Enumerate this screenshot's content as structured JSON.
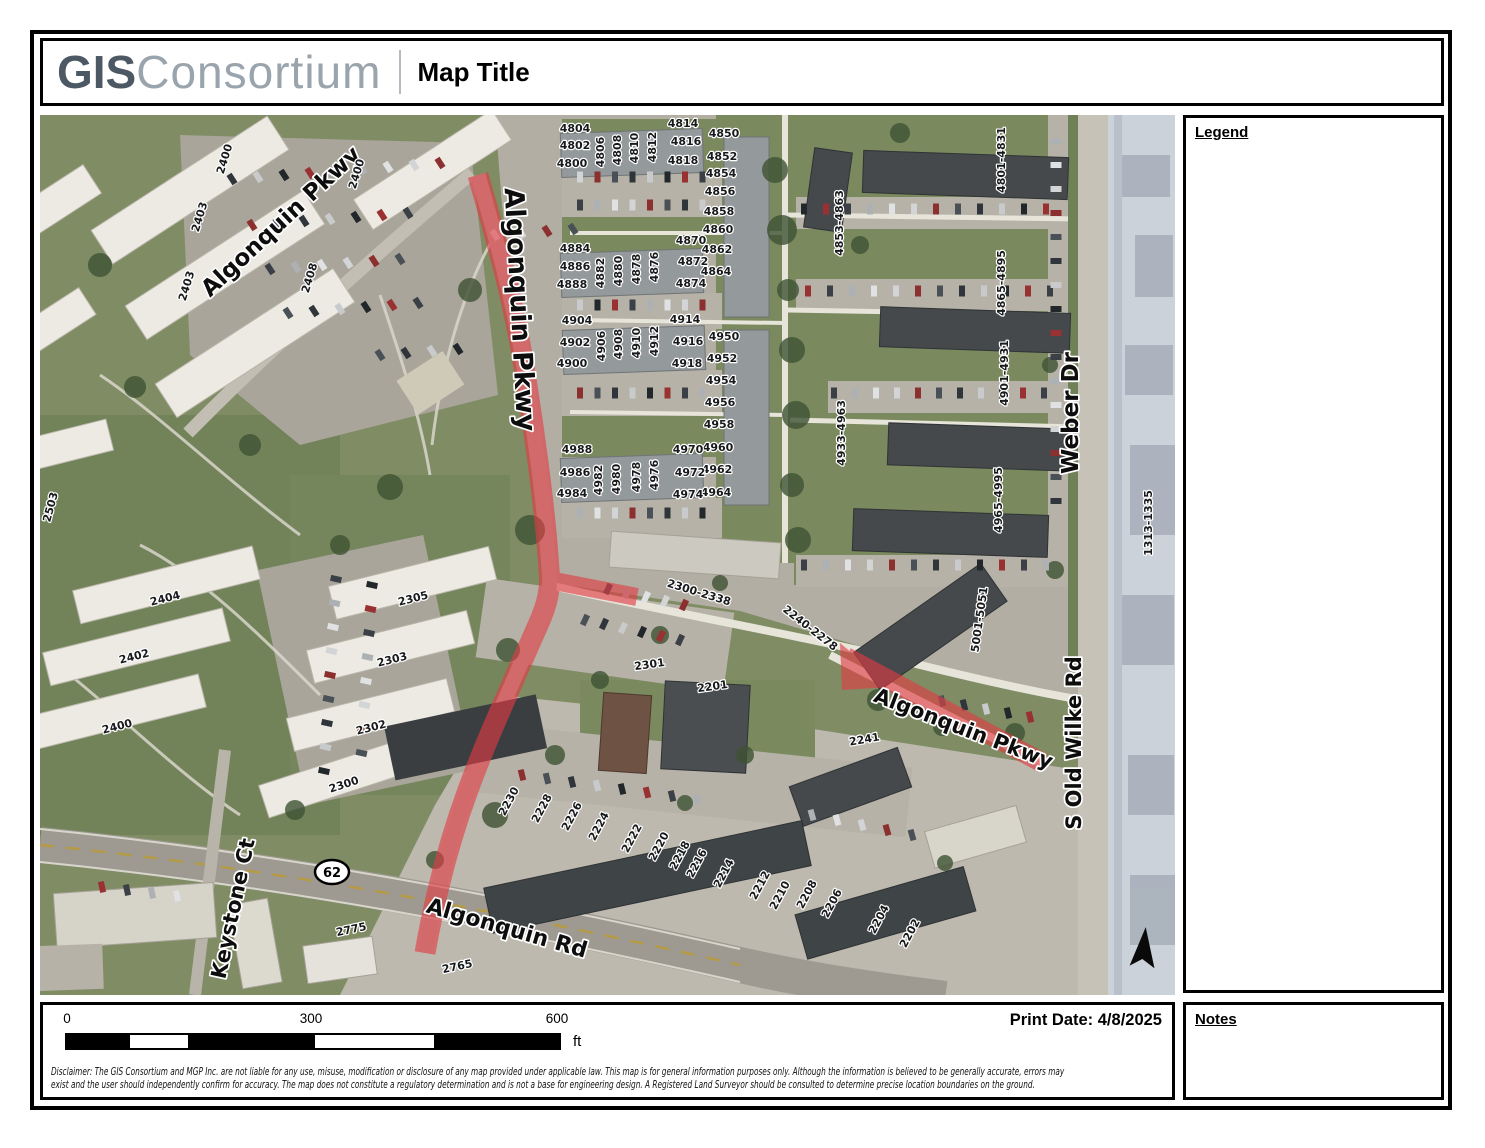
{
  "header": {
    "brand_bold": "GIS",
    "brand_light": "Consortium",
    "title": "Map Title"
  },
  "panels": {
    "legend_title": "Legend",
    "notes_title": "Notes"
  },
  "footer": {
    "print_date": "Print Date: 4/8/2025",
    "disclaimer_line1": "Disclaimer: The GIS Consortium and MGP Inc. are not liable for any use, misuse, modification or disclosure of any map provided under applicable law.  This map is for general information purposes only. Although the information is believed to be generally accurate, errors may",
    "disclaimer_line2": "exist and the user should independently confirm for accuracy. The map does not constitute a regulatory determination and is not a base for engineering design. A Registered Land Surveyor should be consulted to determine precise location boundaries on the ground."
  },
  "scalebar": {
    "start": "0",
    "middle": "300",
    "end": "600",
    "unit": "ft"
  },
  "map": {
    "highlight_color": "#e23c44",
    "route_shield": "62",
    "street_labels": [
      {
        "t": "Algonquin Pkwy",
        "x": 246,
        "y": 112,
        "r": -43,
        "s": 23
      },
      {
        "t": "Algonquin Pkwy",
        "x": 471,
        "y": 195,
        "r": 87,
        "s": 27
      },
      {
        "t": "Weber Dr",
        "x": 1038,
        "y": 298,
        "r": -90,
        "s": 23
      },
      {
        "t": "S Old Wilke Rd",
        "x": 1041,
        "y": 628,
        "r": -90,
        "s": 21
      },
      {
        "t": "Algonquin Pkwy",
        "x": 921,
        "y": 620,
        "r": 21,
        "s": 21
      },
      {
        "t": "Algonquin Rd",
        "x": 465,
        "y": 820,
        "r": 16,
        "s": 22
      },
      {
        "t": "Keystone Ct",
        "x": 200,
        "y": 795,
        "r": -78,
        "s": 21
      }
    ],
    "address_labels": [
      {
        "t": "4804",
        "x": 535,
        "y": 17
      },
      {
        "t": "4802",
        "x": 535,
        "y": 34
      },
      {
        "t": "4800",
        "x": 532,
        "y": 52
      },
      {
        "t": "4806",
        "x": 564,
        "y": 37,
        "r": -90
      },
      {
        "t": "4808",
        "x": 581,
        "y": 35,
        "r": -90
      },
      {
        "t": "4810",
        "x": 598,
        "y": 33,
        "r": -90
      },
      {
        "t": "4812",
        "x": 616,
        "y": 32,
        "r": -90
      },
      {
        "t": "4814",
        "x": 643,
        "y": 12
      },
      {
        "t": "4816",
        "x": 646,
        "y": 30
      },
      {
        "t": "4818",
        "x": 643,
        "y": 49
      },
      {
        "t": "4850",
        "x": 684,
        "y": 22
      },
      {
        "t": "4852",
        "x": 682,
        "y": 45
      },
      {
        "t": "4854",
        "x": 681,
        "y": 62
      },
      {
        "t": "4856",
        "x": 680,
        "y": 80
      },
      {
        "t": "4858",
        "x": 679,
        "y": 100
      },
      {
        "t": "4860",
        "x": 678,
        "y": 118
      },
      {
        "t": "4862",
        "x": 677,
        "y": 138
      },
      {
        "t": "4864",
        "x": 676,
        "y": 160
      },
      {
        "t": "4884",
        "x": 535,
        "y": 137
      },
      {
        "t": "4886",
        "x": 535,
        "y": 155
      },
      {
        "t": "4888",
        "x": 532,
        "y": 173
      },
      {
        "t": "4882",
        "x": 564,
        "y": 158,
        "r": -90
      },
      {
        "t": "4880",
        "x": 582,
        "y": 156,
        "r": -90
      },
      {
        "t": "4878",
        "x": 600,
        "y": 154,
        "r": -90
      },
      {
        "t": "4876",
        "x": 618,
        "y": 152,
        "r": -90
      },
      {
        "t": "4870",
        "x": 651,
        "y": 129
      },
      {
        "t": "4872",
        "x": 653,
        "y": 150
      },
      {
        "t": "4874",
        "x": 651,
        "y": 172
      },
      {
        "t": "4904",
        "x": 537,
        "y": 209
      },
      {
        "t": "4902",
        "x": 535,
        "y": 231
      },
      {
        "t": "4900",
        "x": 532,
        "y": 252
      },
      {
        "t": "4906",
        "x": 565,
        "y": 231,
        "r": -90
      },
      {
        "t": "4908",
        "x": 582,
        "y": 229,
        "r": -90
      },
      {
        "t": "4910",
        "x": 600,
        "y": 228,
        "r": -90
      },
      {
        "t": "4912",
        "x": 618,
        "y": 226,
        "r": -90
      },
      {
        "t": "4914",
        "x": 645,
        "y": 208
      },
      {
        "t": "4916",
        "x": 648,
        "y": 230
      },
      {
        "t": "4918",
        "x": 647,
        "y": 252
      },
      {
        "t": "4950",
        "x": 684,
        "y": 225
      },
      {
        "t": "4952",
        "x": 682,
        "y": 247
      },
      {
        "t": "4954",
        "x": 681,
        "y": 269
      },
      {
        "t": "4956",
        "x": 680,
        "y": 291
      },
      {
        "t": "4958",
        "x": 679,
        "y": 313
      },
      {
        "t": "4960",
        "x": 678,
        "y": 336
      },
      {
        "t": "4962",
        "x": 677,
        "y": 358
      },
      {
        "t": "4964",
        "x": 676,
        "y": 381
      },
      {
        "t": "4988",
        "x": 537,
        "y": 338
      },
      {
        "t": "4986",
        "x": 535,
        "y": 361
      },
      {
        "t": "4984",
        "x": 532,
        "y": 382
      },
      {
        "t": "4982",
        "x": 562,
        "y": 365,
        "r": -90
      },
      {
        "t": "4980",
        "x": 580,
        "y": 364,
        "r": -90
      },
      {
        "t": "4978",
        "x": 600,
        "y": 362,
        "r": -90
      },
      {
        "t": "4976",
        "x": 618,
        "y": 360,
        "r": -90
      },
      {
        "t": "4970",
        "x": 648,
        "y": 338
      },
      {
        "t": "4972",
        "x": 650,
        "y": 361
      },
      {
        "t": "4974",
        "x": 648,
        "y": 383
      },
      {
        "t": "4853-4863",
        "x": 803,
        "y": 108,
        "r": -90,
        "s": 12
      },
      {
        "t": "4801-4831",
        "x": 965,
        "y": 45,
        "r": -90,
        "s": 12
      },
      {
        "t": "4865-4895",
        "x": 965,
        "y": 168,
        "r": -90,
        "s": 12
      },
      {
        "t": "4901-4931",
        "x": 968,
        "y": 258,
        "r": -90,
        "s": 12
      },
      {
        "t": "4933-4963",
        "x": 805,
        "y": 318,
        "r": -90,
        "s": 12
      },
      {
        "t": "4965-4995",
        "x": 962,
        "y": 385,
        "r": -90,
        "s": 12
      },
      {
        "t": "5001-5051",
        "x": 943,
        "y": 505,
        "r": -82,
        "s": 12
      },
      {
        "t": "1313-1335",
        "x": 1112,
        "y": 408,
        "r": -90,
        "s": 11,
        "f": "#4a4f58"
      },
      {
        "t": "2400",
        "x": 188,
        "y": 45,
        "r": -73
      },
      {
        "t": "2403",
        "x": 163,
        "y": 103,
        "r": -73
      },
      {
        "t": "2403",
        "x": 150,
        "y": 172,
        "r": -73
      },
      {
        "t": "2400",
        "x": 320,
        "y": 60,
        "r": -73
      },
      {
        "t": "2408",
        "x": 273,
        "y": 164,
        "r": -73
      },
      {
        "t": "2404",
        "x": 126,
        "y": 487,
        "r": -14
      },
      {
        "t": "2402",
        "x": 95,
        "y": 545,
        "r": -14
      },
      {
        "t": "2400",
        "x": 78,
        "y": 615,
        "r": -14
      },
      {
        "t": "2305",
        "x": 374,
        "y": 487,
        "r": -14
      },
      {
        "t": "2303",
        "x": 353,
        "y": 548,
        "r": -14
      },
      {
        "t": "2302",
        "x": 332,
        "y": 616,
        "r": -14
      },
      {
        "t": "2300",
        "x": 305,
        "y": 673,
        "r": -18
      },
      {
        "t": "2503",
        "x": 14,
        "y": 393,
        "r": -75
      },
      {
        "t": "2775",
        "x": 312,
        "y": 818,
        "r": -12
      },
      {
        "t": "2765",
        "x": 418,
        "y": 855,
        "r": -12
      },
      {
        "t": "2241",
        "x": 825,
        "y": 628,
        "r": -10
      },
      {
        "t": "2301",
        "x": 610,
        "y": 553,
        "r": -8
      },
      {
        "t": "2201",
        "x": 673,
        "y": 575,
        "r": -8
      },
      {
        "t": "2300-2338",
        "x": 658,
        "y": 481,
        "r": 17,
        "s": 12
      },
      {
        "t": "2240-2278",
        "x": 768,
        "y": 516,
        "r": 38,
        "s": 12
      },
      {
        "t": "2230",
        "x": 472,
        "y": 688,
        "r": -62
      },
      {
        "t": "2228",
        "x": 505,
        "y": 695,
        "r": -62
      },
      {
        "t": "2226",
        "x": 535,
        "y": 703,
        "r": -62
      },
      {
        "t": "2224",
        "x": 562,
        "y": 713,
        "r": -62
      },
      {
        "t": "2222",
        "x": 595,
        "y": 725,
        "r": -62
      },
      {
        "t": "2220",
        "x": 622,
        "y": 733,
        "r": -62
      },
      {
        "t": "2218",
        "x": 643,
        "y": 742,
        "r": -62
      },
      {
        "t": "2216",
        "x": 660,
        "y": 750,
        "r": -62
      },
      {
        "t": "2214",
        "x": 687,
        "y": 760,
        "r": -62
      },
      {
        "t": "2212",
        "x": 723,
        "y": 772,
        "r": -62
      },
      {
        "t": "2210",
        "x": 743,
        "y": 782,
        "r": -62
      },
      {
        "t": "2208",
        "x": 770,
        "y": 781,
        "r": -62
      },
      {
        "t": "2206",
        "x": 795,
        "y": 790,
        "r": -62
      },
      {
        "t": "2204",
        "x": 842,
        "y": 806,
        "r": -62
      },
      {
        "t": "2202",
        "x": 873,
        "y": 820,
        "r": -62
      }
    ]
  }
}
